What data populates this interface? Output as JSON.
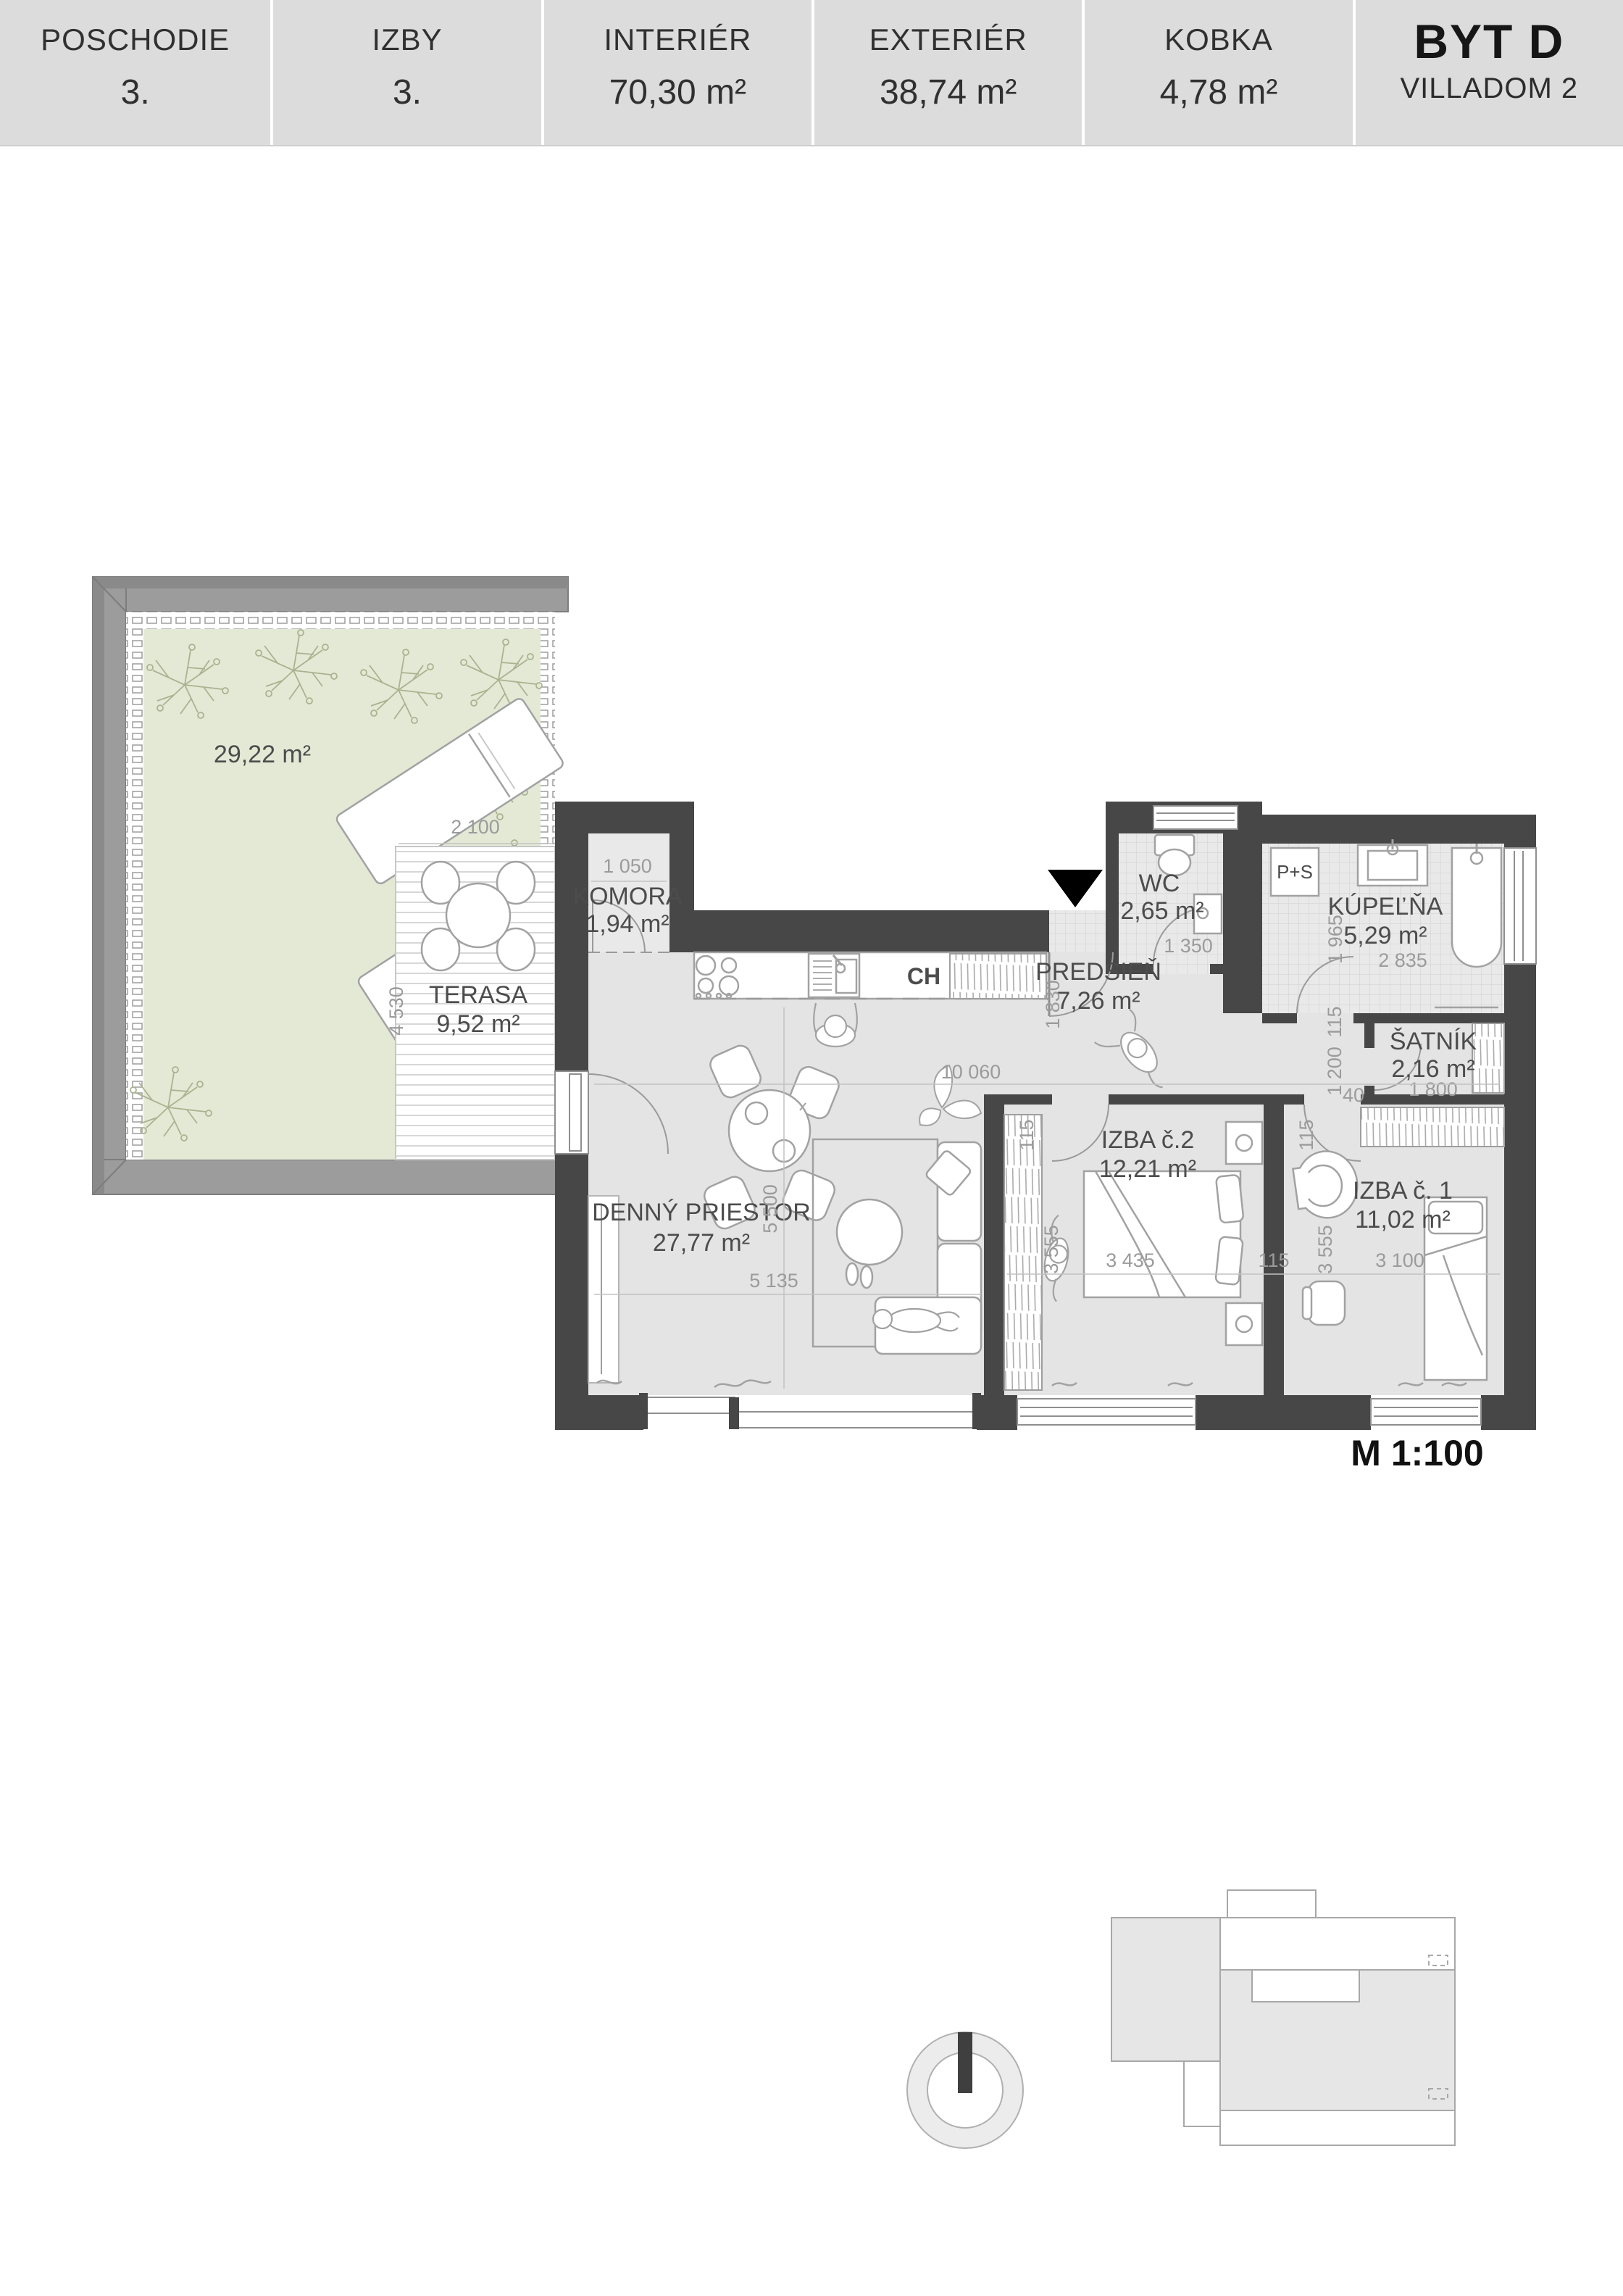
{
  "header": {
    "columns": [
      {
        "label": "POSCHODIE",
        "value": "3."
      },
      {
        "label": "IZBY",
        "value": "3."
      },
      {
        "label": "INTERIÉR",
        "value": "70,30 m²"
      },
      {
        "label": "EXTERIÉR",
        "value": "38,74 m²"
      },
      {
        "label": "KOBKA",
        "value": "4,78 m²"
      }
    ],
    "unit": {
      "name": "BYT D",
      "building": "VILLADOM 2"
    }
  },
  "plan": {
    "scale_label": "M 1:100",
    "rooms": {
      "garden": {
        "area": "29,22 m²"
      },
      "terasa": {
        "name": "TERASA",
        "area": "9,52 m²"
      },
      "komora": {
        "name": "KOMORA",
        "area": "1,94 m²"
      },
      "wc": {
        "name": "WC",
        "area": "2,65 m²"
      },
      "kupelna": {
        "name": "KÚPEĽŇA",
        "area": "5,29 m²"
      },
      "predsien": {
        "name": "PREDSIEŇ",
        "area": "7,26 m²"
      },
      "satnik": {
        "name": "ŠATNÍK",
        "area": "2,16 m²"
      },
      "denny": {
        "name": "DENNÝ PRIESTOR",
        "area": "27,77 m²"
      },
      "izba2": {
        "name": "IZBA č.2",
        "area": "12,21 m²"
      },
      "izba1": {
        "name": "IZBA č. 1",
        "area": "11,02 m²"
      }
    },
    "appliances": {
      "fridge": "CH",
      "washer_dryer": "P+S"
    },
    "dims": {
      "terasa_w": "2 100",
      "terasa_h": "4 530",
      "komora_w": "1 050",
      "main_w": "10 060",
      "living_w": "5 135",
      "living_h": "5 500",
      "wc_w": "1 350",
      "kupelna_w": "2 835",
      "kupelna_h": "1 965",
      "predsien_h": "1 830",
      "satnik_w": "1 800",
      "hall_len": "1 200",
      "hall_gap": "40",
      "wall": "115",
      "izba2_w": "3 435",
      "izba2_h": "3 555",
      "izba1_w": "3 100",
      "izba1_h": "3 555"
    },
    "colors": {
      "wall": "#474747",
      "floor": "#e4e4e4",
      "tile": "#e9e9e9",
      "green": "#e4e9d6",
      "parapet": "#9c9c9c",
      "header_bg": "#dcdcdc",
      "north_marker": "#3f3f3f"
    }
  }
}
